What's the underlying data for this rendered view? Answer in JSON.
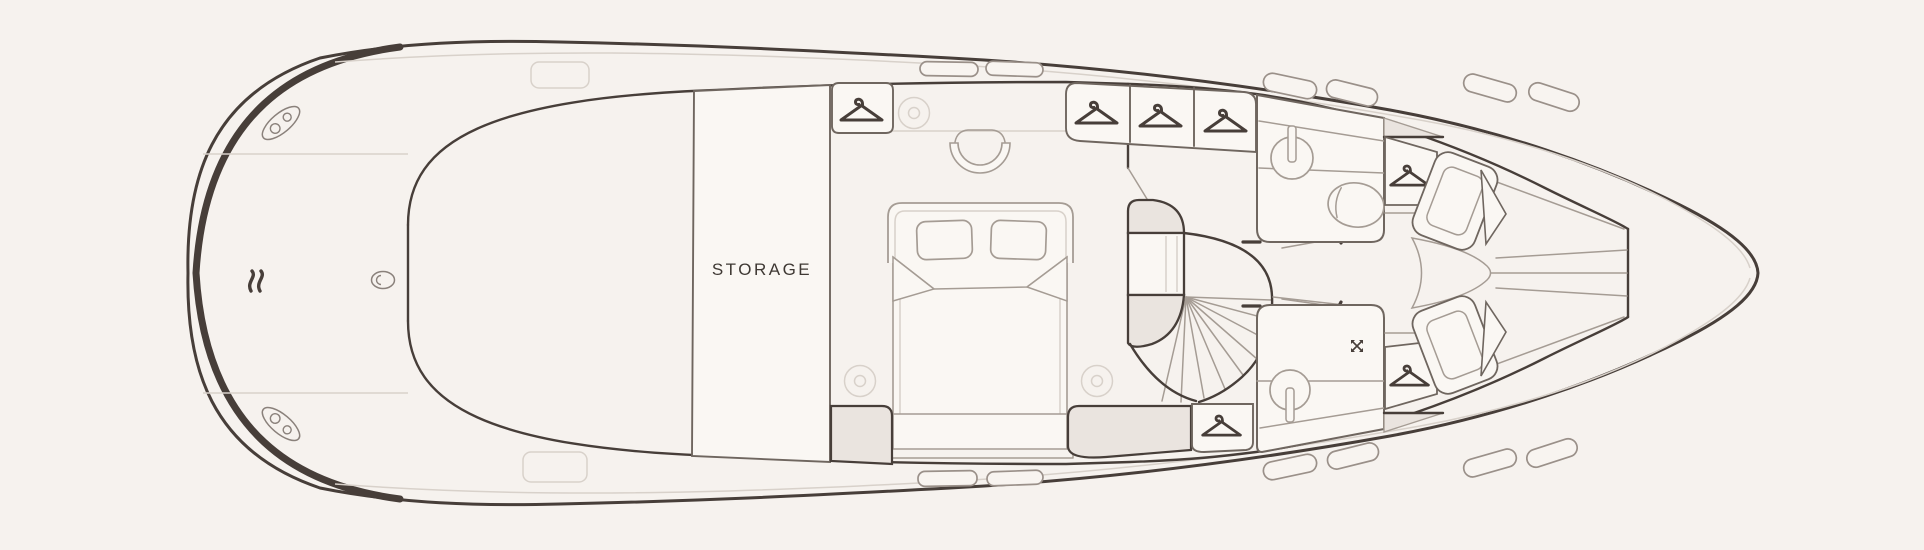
{
  "canvas": {
    "width": 1924,
    "height": 550
  },
  "colors": {
    "background": "#f6f2ee",
    "hull": "#473e39",
    "wall": "#6f665f",
    "furniture": "#a59c94",
    "faint": "#d8d1ca",
    "room_fill": "#faf7f3",
    "shaded_fill": "#eae4df",
    "text": "#3e3833"
  },
  "floorplan": {
    "type": "yacht-lower-deck-floor-plan",
    "labels": {
      "storage": "STORAGE"
    },
    "areas": [
      "swim-platform",
      "aft-deck",
      "storage-room",
      "master-cabin",
      "midship-lobby",
      "spiral-staircase",
      "bathroom",
      "shower-room",
      "bow-cabin"
    ],
    "icons": {
      "hanger_closets": 7,
      "ceiling_lights": 3,
      "sinks": 2,
      "toilets": 1,
      "shower_heads": 1,
      "mooring_cleats": 2,
      "deck_hatches": 14
    }
  }
}
